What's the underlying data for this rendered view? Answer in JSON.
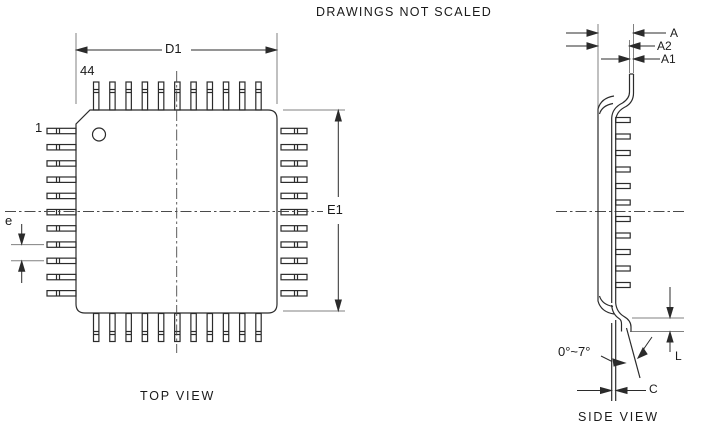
{
  "title": "DRAWINGS NOT SCALED",
  "top_view": {
    "caption": "TOP VIEW",
    "pins_per_side": 11,
    "pin_count_label": "44",
    "pin_one_label": "1",
    "dim_horizontal": "D1",
    "dim_vertical": "E1",
    "dim_pitch": "e"
  },
  "side_view": {
    "caption": "SIDE VIEW",
    "dim_overall_height": "A",
    "dim_body_thickness": "A2",
    "dim_standoff": "A1",
    "dim_foot_length": "L",
    "dim_lead_thickness": "C",
    "dim_foot_angle": "0°~7°"
  },
  "colors": {
    "line": "#2b2b2b",
    "extension_line": "#808080",
    "centerline": "#4a4a4a",
    "background": "#ffffff"
  },
  "geometry": {
    "pins_per_side": 11,
    "pin_pitch": 16.23,
    "side_stub_pitch": 16.5
  }
}
